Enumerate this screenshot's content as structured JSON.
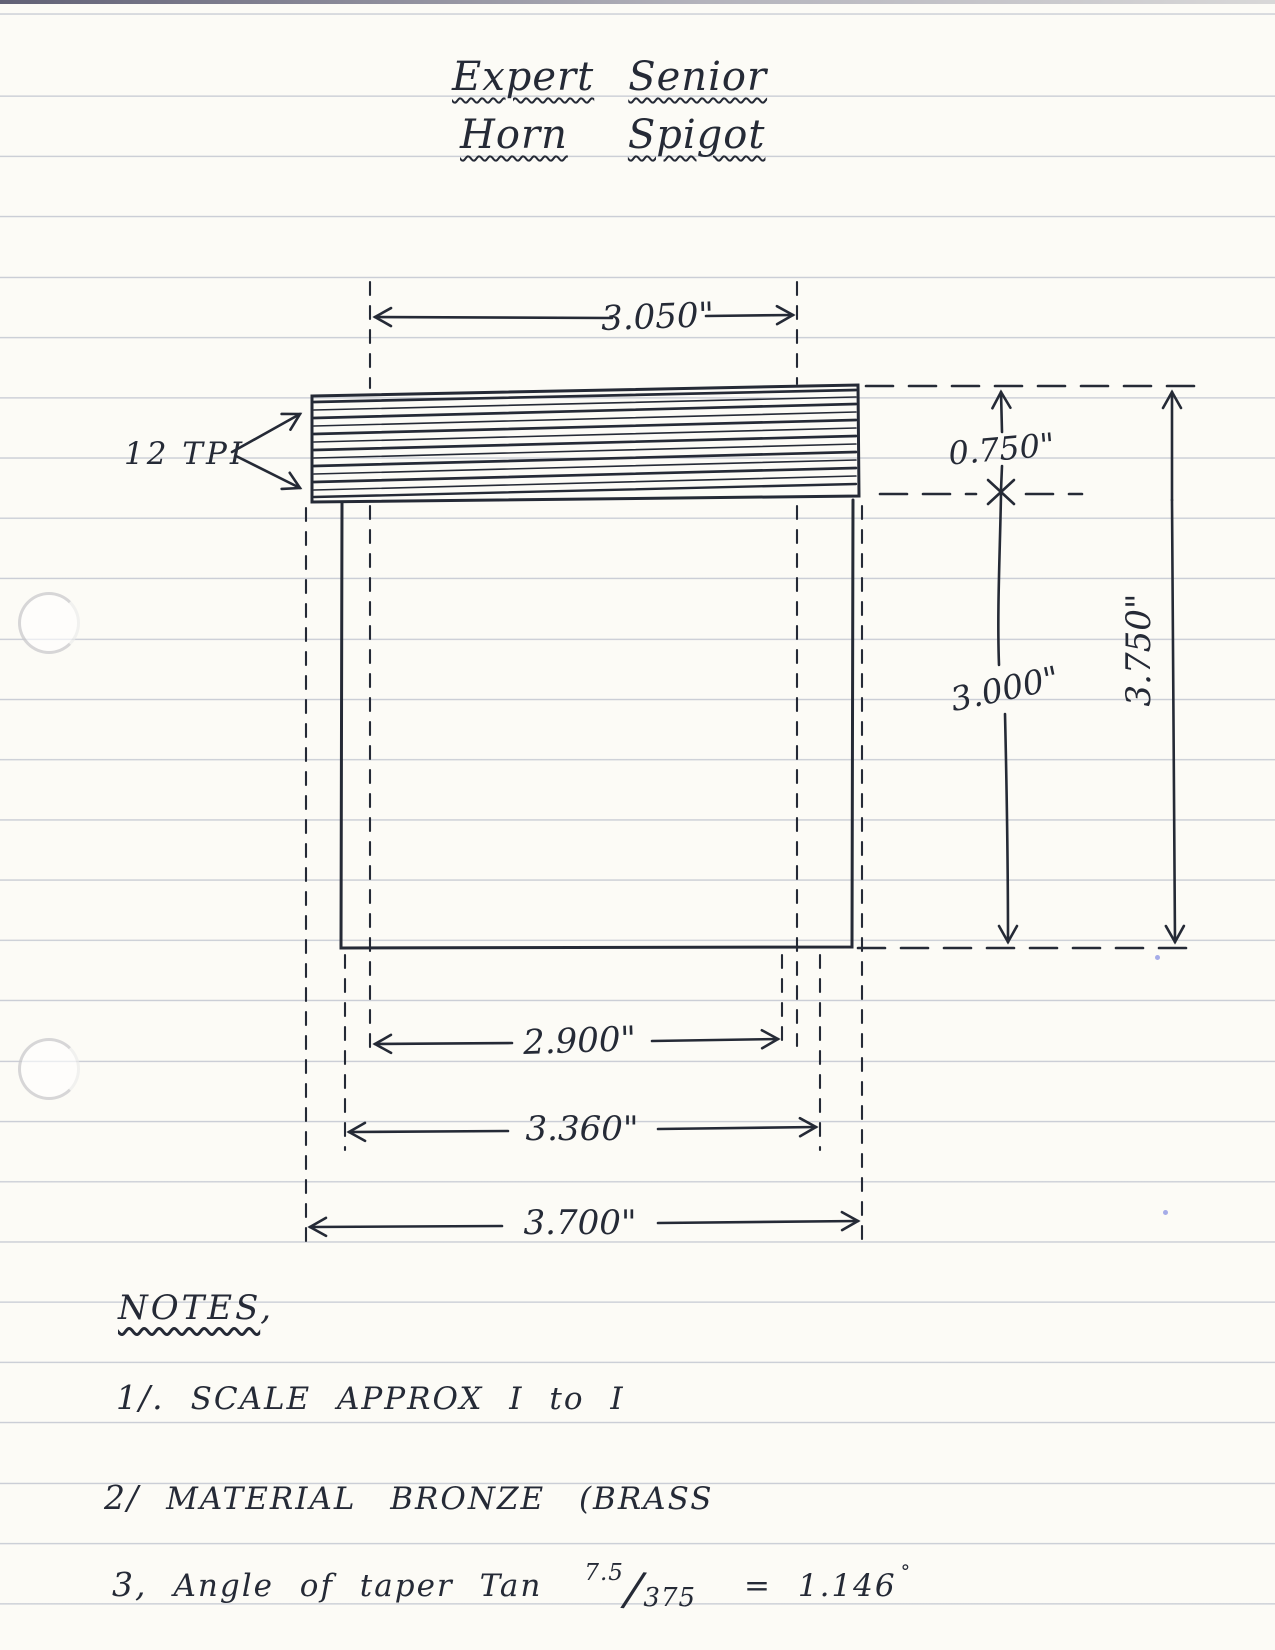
{
  "title": {
    "word1": "Expert",
    "word2": "Senior",
    "word3": "Horn",
    "word4": "Spigot"
  },
  "drawing": {
    "thread_label": "12 TPI",
    "dims": {
      "top_width": "3.050\"",
      "thread_height": "0.750\"",
      "body_height": "3.000\"",
      "total_height": "3.750\"",
      "inner_width": "2.900\"",
      "body_width": "3.360\"",
      "outer_width": "3.700\""
    }
  },
  "notes": {
    "heading": "NOTES",
    "heading_comma": ",",
    "items": [
      {
        "num": "1/.",
        "text": "SCALE  APPROX  I to I"
      },
      {
        "num": "2/",
        "text": "MATERIAL  BRONZE  (BRASS"
      },
      {
        "num": "3,",
        "text": "Angle of taper Tan",
        "frac_num": "7.5",
        "frac_den": "375",
        "result": "= 1.146",
        "degree": "°"
      }
    ]
  },
  "colors": {
    "ink": "#252a36",
    "paper": "#fcfbf6",
    "rule_line": "#6c7898"
  }
}
